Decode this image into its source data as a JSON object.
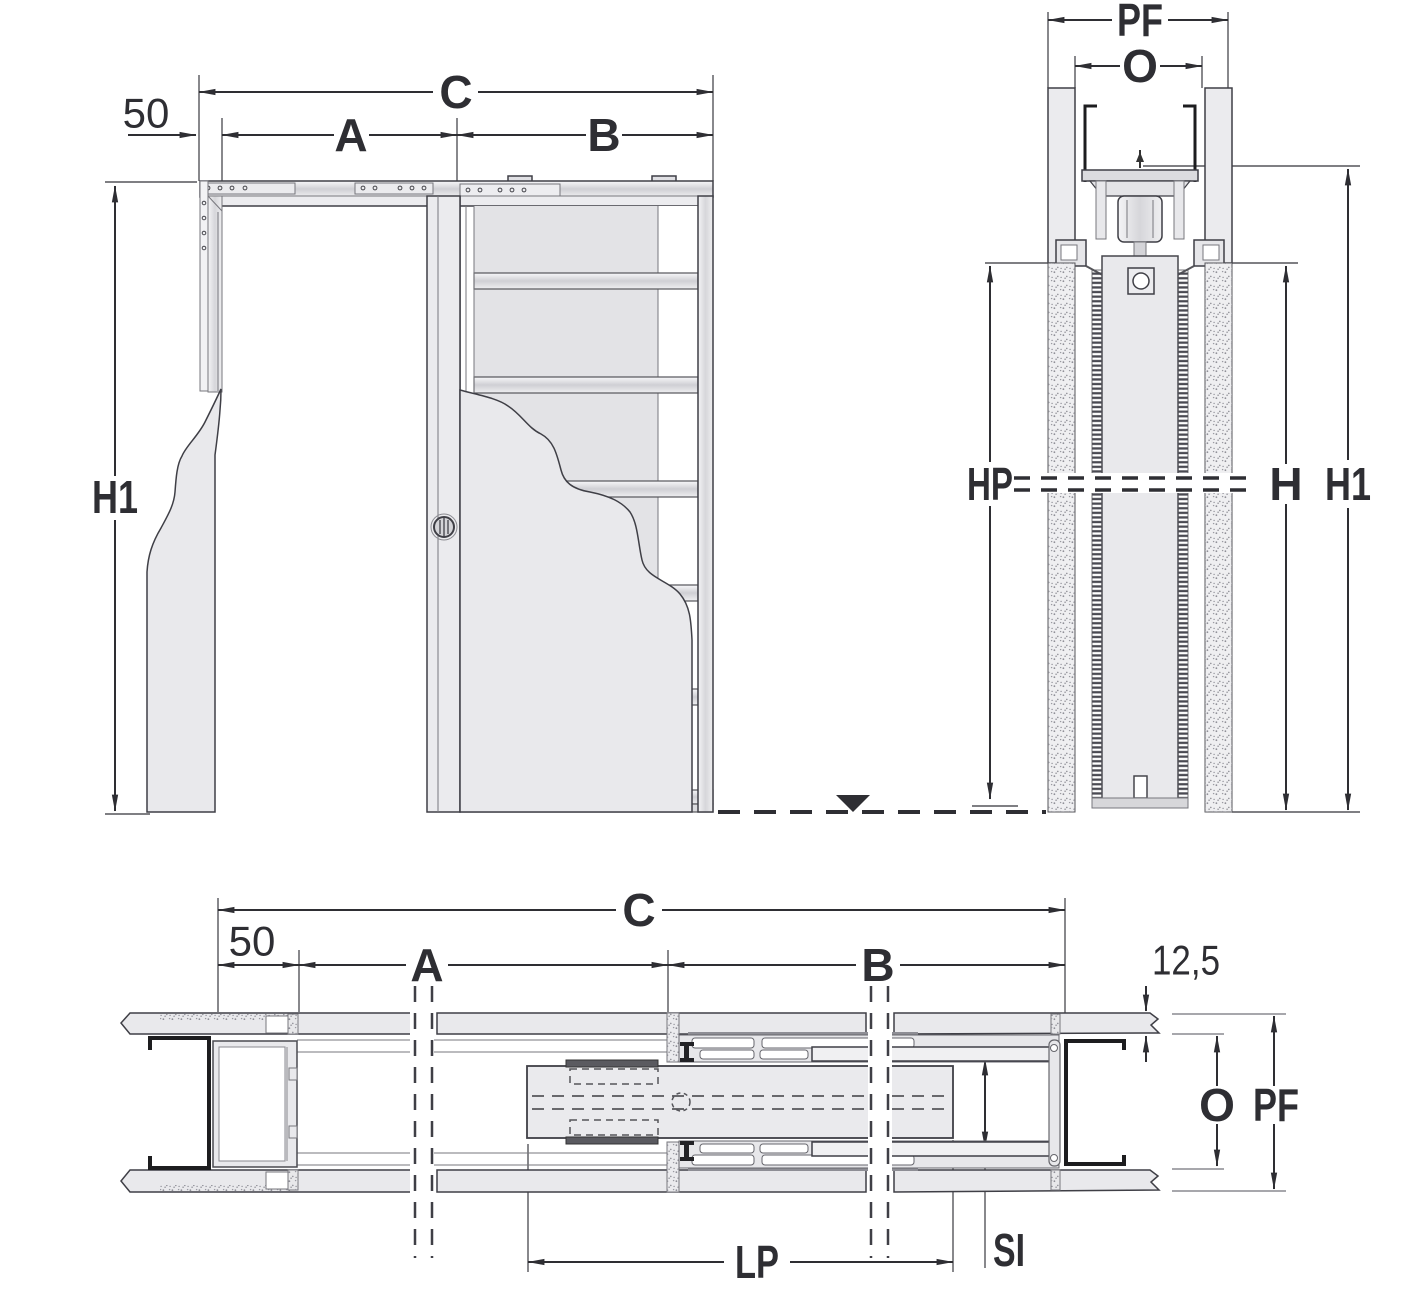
{
  "drawing_title": "Pocket sliding door frame installation diagram",
  "colors": {
    "background": "#ffffff",
    "line": "#3f3f46",
    "dimension": "#2e2e33",
    "panel_fill": "#e9e9ec",
    "mesh_fill": "#e3e3e6",
    "metal_mid": "#cfcfd4",
    "black_profile": "#1d1d1f",
    "stipple_dot": "#8f8f97"
  },
  "labels": {
    "front": {
      "c": "C",
      "a": "A",
      "b": "B",
      "offset": "50",
      "h1": "H1"
    },
    "section": {
      "pf": "PF",
      "o": "O",
      "hp": "HP",
      "h": "H",
      "h1": "H1"
    },
    "plan": {
      "c": "C",
      "offset": "50",
      "a": "A",
      "b": "B",
      "board": "12,5",
      "o": "O",
      "pf": "PF",
      "lp": "LP",
      "si": "SI"
    }
  }
}
